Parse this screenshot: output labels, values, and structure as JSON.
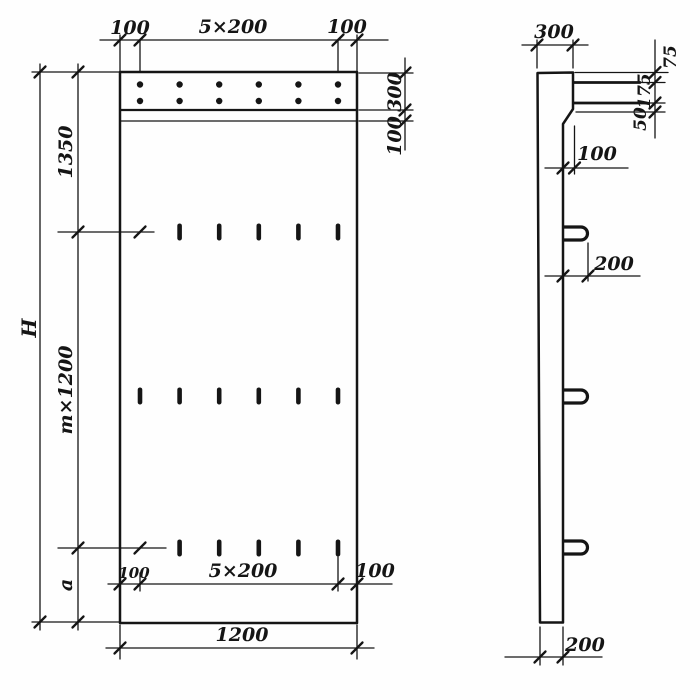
{
  "front_view": {
    "top_dims": {
      "left": "100",
      "center": "5×200",
      "right": "100"
    },
    "left_dims": {
      "overall": "H",
      "top": "1350",
      "middle": "m×1200",
      "bottom": "a"
    },
    "right_dims": {
      "band": "300",
      "strip": "100"
    },
    "inner_bottom_dims": {
      "left": "100",
      "center": "5×200",
      "right": "100"
    },
    "bottom_dim": "1200"
  },
  "side_view": {
    "top_dim": "300",
    "edge_dims": {
      "top": "75",
      "middle": "175",
      "bottom": "50"
    },
    "step_dim": "100",
    "loop_dim": "200",
    "thickness_dim": "200"
  },
  "colors": {
    "ink": "#151515",
    "paper": "#fefefe"
  }
}
